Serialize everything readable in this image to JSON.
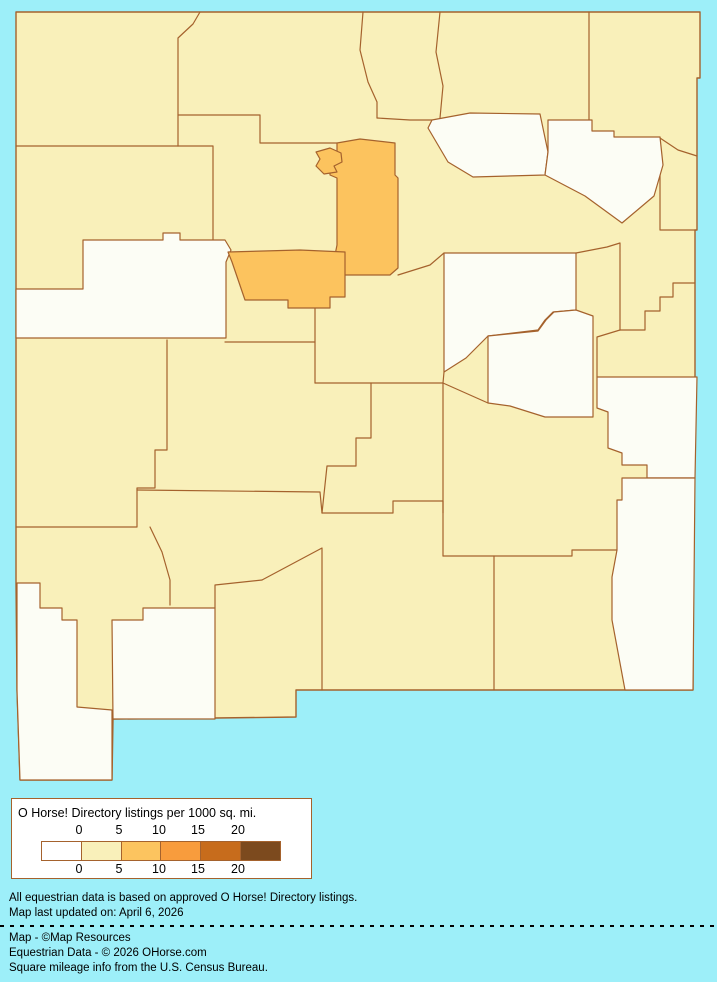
{
  "map": {
    "state": "New Mexico",
    "colors": {
      "background": "#9DEFF9",
      "county_fill": "#F9F0BA",
      "zero_density_fill": "#FCFDF5",
      "mid_density_fill": "#FCC35E",
      "border": "#A5622D"
    }
  },
  "legend": {
    "title": "O Horse! Directory listings per 1000 sq. mi.",
    "ticks_top": [
      "0",
      "5",
      "10",
      "15",
      "20"
    ],
    "ticks_bottom": [
      "0",
      "5",
      "10",
      "15",
      "20"
    ],
    "swatches": [
      "#FFFFFF",
      "#F9F0BA",
      "#FCC45F",
      "#F89C3D",
      "#C76C1C",
      "#7C4A1E"
    ]
  },
  "notes": {
    "line1": "All equestrian data is based on approved O Horse! Directory listings.",
    "line2": "Map last updated on: April 6, 2026"
  },
  "credits": {
    "line1": "Map - ©Map Resources",
    "line2": "Equestrian Data - © 2026 OHorse.com",
    "line3": "Square mileage info from the U.S. Census Bureau."
  }
}
